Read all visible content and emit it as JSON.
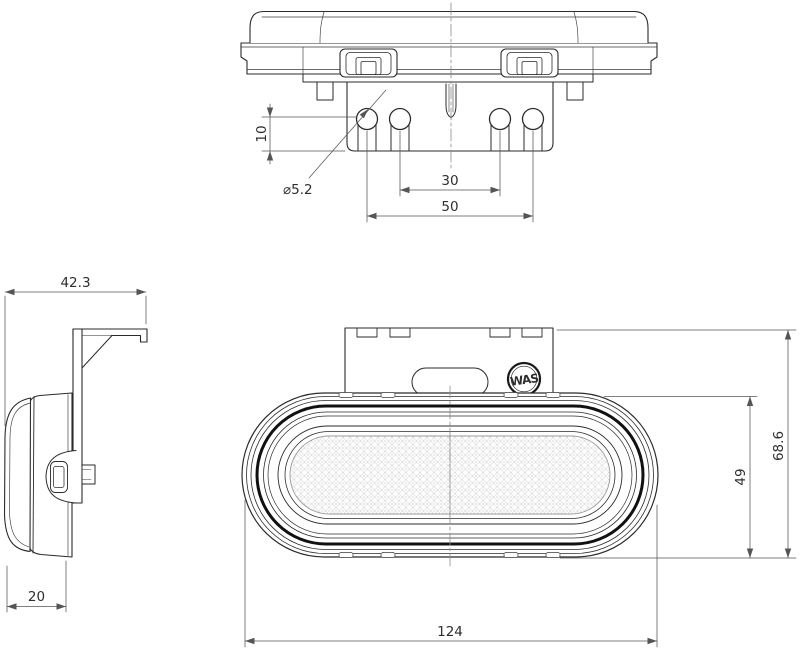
{
  "drawing": {
    "logo": "WAS",
    "top_view": {
      "pin_length": "10",
      "pin_diameter": "⌀5.2",
      "pin_spacing_inner": "30",
      "pin_spacing_outer": "50"
    },
    "side_view": {
      "total_depth": "42.3",
      "body_depth": "20"
    },
    "front_view": {
      "body_height": "49",
      "total_height": "68.6",
      "body_width": "124"
    }
  }
}
